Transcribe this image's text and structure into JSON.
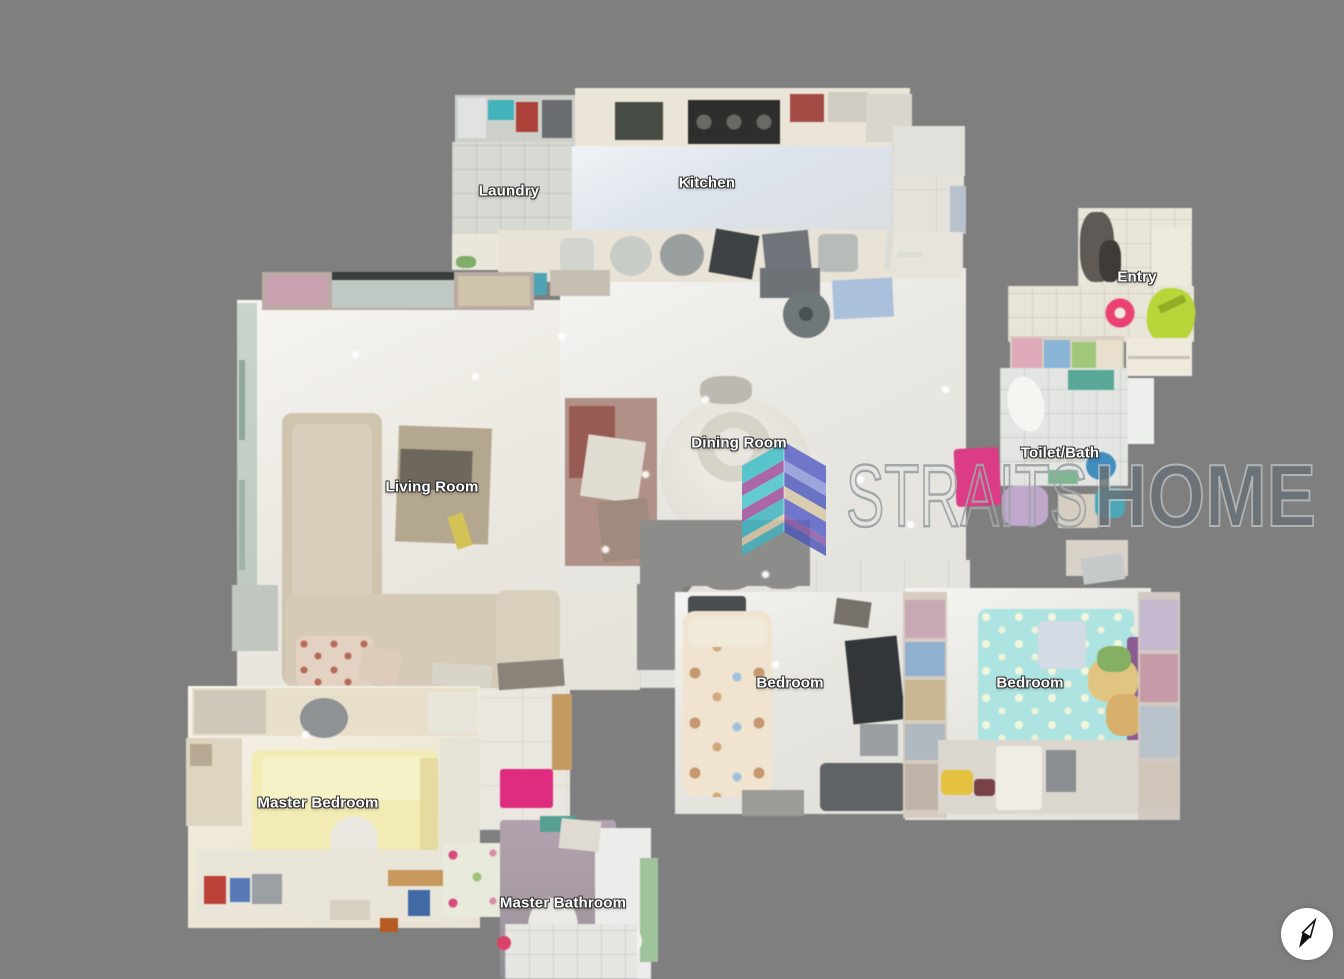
{
  "view": {
    "type": "dollhouse-floorplan",
    "background_color": "#7f7f7f"
  },
  "rooms": [
    {
      "id": "laundry",
      "label": "Laundry"
    },
    {
      "id": "kitchen",
      "label": "Kitchen"
    },
    {
      "id": "entry",
      "label": "Entry"
    },
    {
      "id": "dining-room",
      "label": "Dining Room"
    },
    {
      "id": "living-room",
      "label": "Living Room"
    },
    {
      "id": "toilet-bath",
      "label": "Toilet/Bath"
    },
    {
      "id": "bedroom-1",
      "label": "Bedroom"
    },
    {
      "id": "bedroom-2",
      "label": "Bedroom"
    },
    {
      "id": "master-bedroom",
      "label": "Master Bedroom"
    },
    {
      "id": "master-bathroom",
      "label": "Master Bathroom"
    }
  ],
  "watermark": {
    "brand_first": "STRAITS",
    "brand_second": "HOME",
    "logo_colors": {
      "teal": "#3fc0cb",
      "purple": "#a04f9f",
      "blue": "#5a62c8",
      "indigo": "#8f9bdc",
      "beige": "#d9c9a8"
    },
    "text_outline_color": "#9ea4a7",
    "text_fill_color": "#687076"
  },
  "colors": {
    "background": "#7f7f7f",
    "label_text": "#ffffff",
    "label_outline": "#333333",
    "compass_bg": "#ffffff",
    "compass_needle": "#111111",
    "entry_doormat_pink": "#ef3f76",
    "hall_mat_pink": "#e03a86",
    "connector_mat_pink": "#e62a80",
    "master_bed_yellow": "#f2ecb2",
    "bedroom_mattress_cyan": "#abe4e2",
    "bedroom_mattress_teddy": "#f0e4cf",
    "sofa_beige": "#cfc5ae",
    "kitchen_floor_blue": "#dee4ec"
  }
}
